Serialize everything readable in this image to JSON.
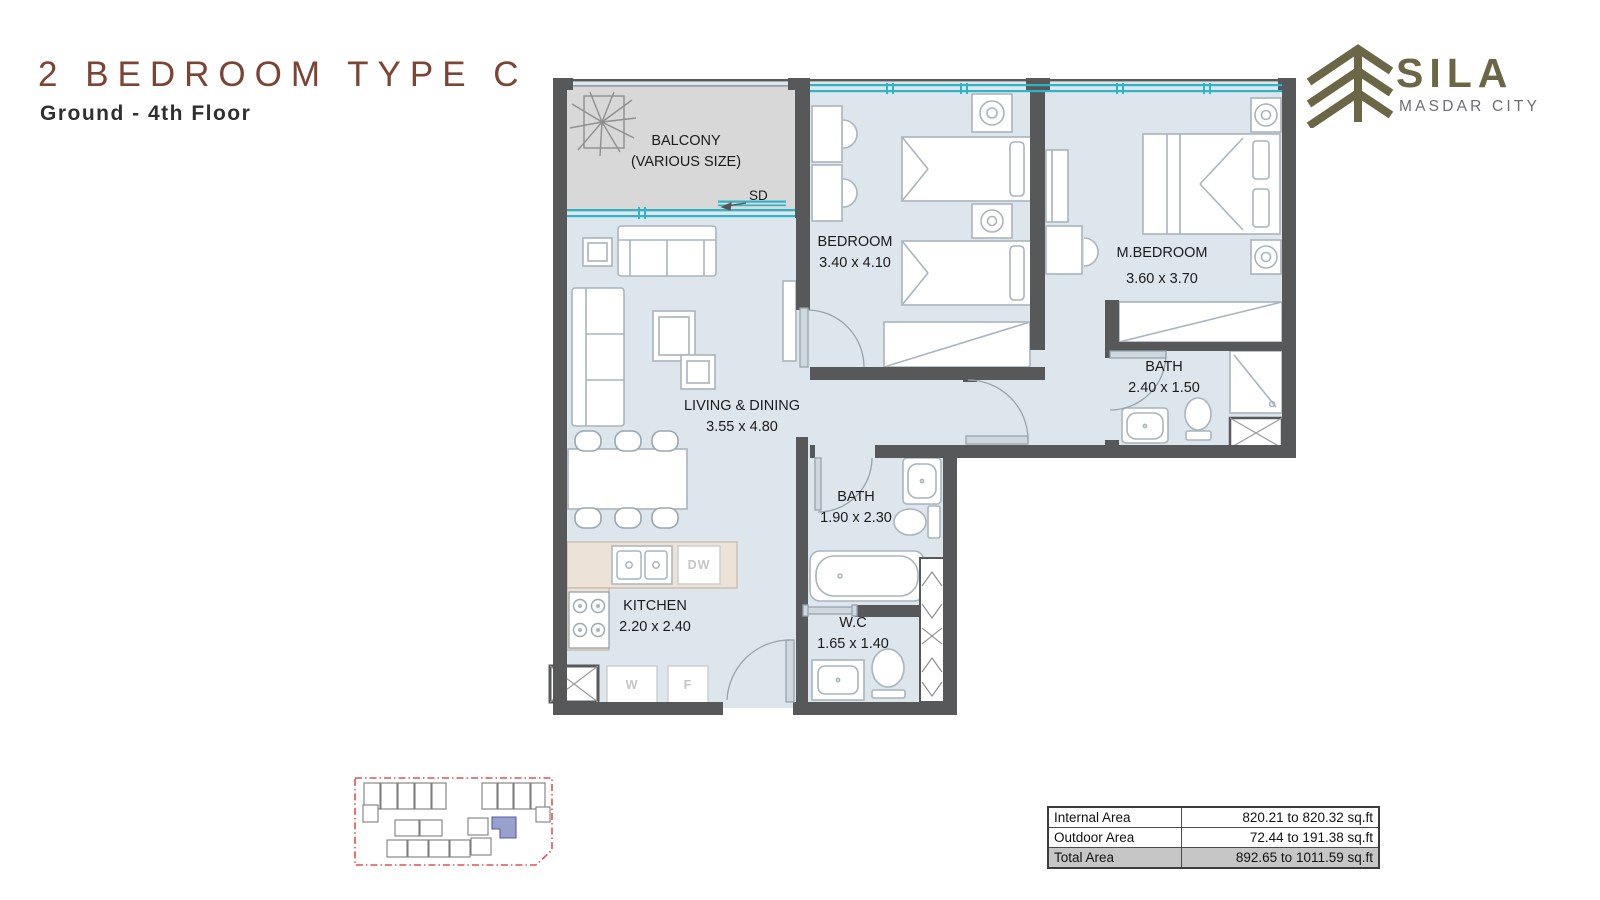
{
  "header": {
    "title": "2 BEDROOM TYPE C",
    "subtitle": "Ground - 4th Floor"
  },
  "logo": {
    "brand": "SILA",
    "tagline": "MASDAR CITY"
  },
  "plan": {
    "rooms": {
      "balcony": {
        "name": "BALCONY",
        "dims": "(VARIOUS SIZE)"
      },
      "bedroom": {
        "name": "BEDROOM",
        "dims": "3.40 x 4.10"
      },
      "master_bedroom": {
        "name": "M.BEDROOM",
        "dims": "3.60 x 3.70"
      },
      "bath_master": {
        "name": "BATH",
        "dims": "2.40 x 1.50"
      },
      "living_dining": {
        "name": "LIVING & DINING",
        "dims": "3.55 x 4.80"
      },
      "bath": {
        "name": "BATH",
        "dims": "1.90 x 2.30"
      },
      "kitchen": {
        "name": "KITCHEN",
        "dims": "2.20 x 2.40"
      },
      "wc": {
        "name": "W.C",
        "dims": "1.65 x 1.40"
      }
    },
    "markers": {
      "sliding_door": "SD",
      "dishwasher": "DW",
      "washer": "W",
      "fridge": "F"
    }
  },
  "area_table": {
    "rows": [
      {
        "label": "Internal Area",
        "value": "820.21 to 820.32 sq.ft"
      },
      {
        "label": "Outdoor Area",
        "value": "72.44 to 191.38 sq.ft"
      },
      {
        "label": "Total Area",
        "value": "892.65 to 1011.59 sq.ft"
      }
    ]
  },
  "colors": {
    "accent_title": "#7c4434",
    "logo_olive": "#6b6746",
    "wall": "#57585a",
    "room_fill": "#dde6ed",
    "balcony_fill": "#d8d8d8",
    "window_teal": "#2fb3c7",
    "site_outline_red": "#e05252",
    "highlight_unit": "#98a1cc"
  }
}
